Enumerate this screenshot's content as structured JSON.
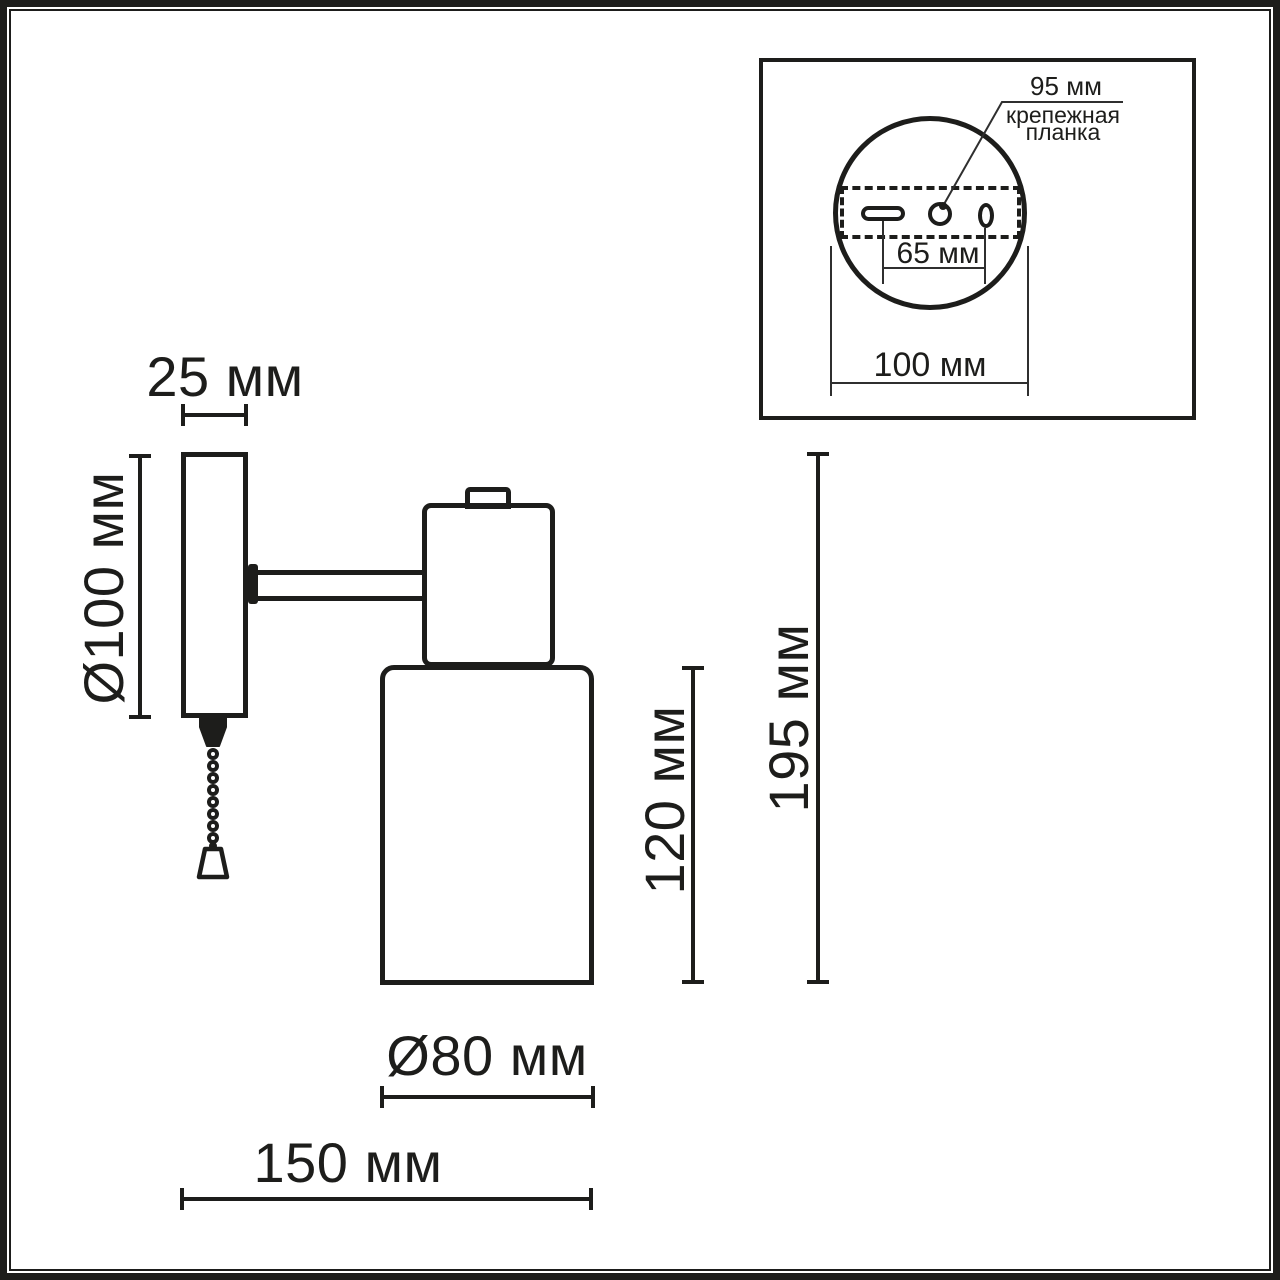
{
  "colors": {
    "ink": "#1d1d1b",
    "thin_line": "#2f2f2f",
    "background": "#ffffff"
  },
  "labels": {
    "main": {
      "plate_width": "25 мм",
      "plate_diameter": "Ø100 мм",
      "shade_height": "120 мм",
      "total_height": "195 мм",
      "shade_diameter": "Ø80 мм",
      "total_depth": "150 мм"
    },
    "inset": {
      "bracket_length": "95 мм",
      "bracket_name": "крепежная планка",
      "hole_spacing": "65 мм",
      "base_diameter": "100 мм"
    }
  }
}
